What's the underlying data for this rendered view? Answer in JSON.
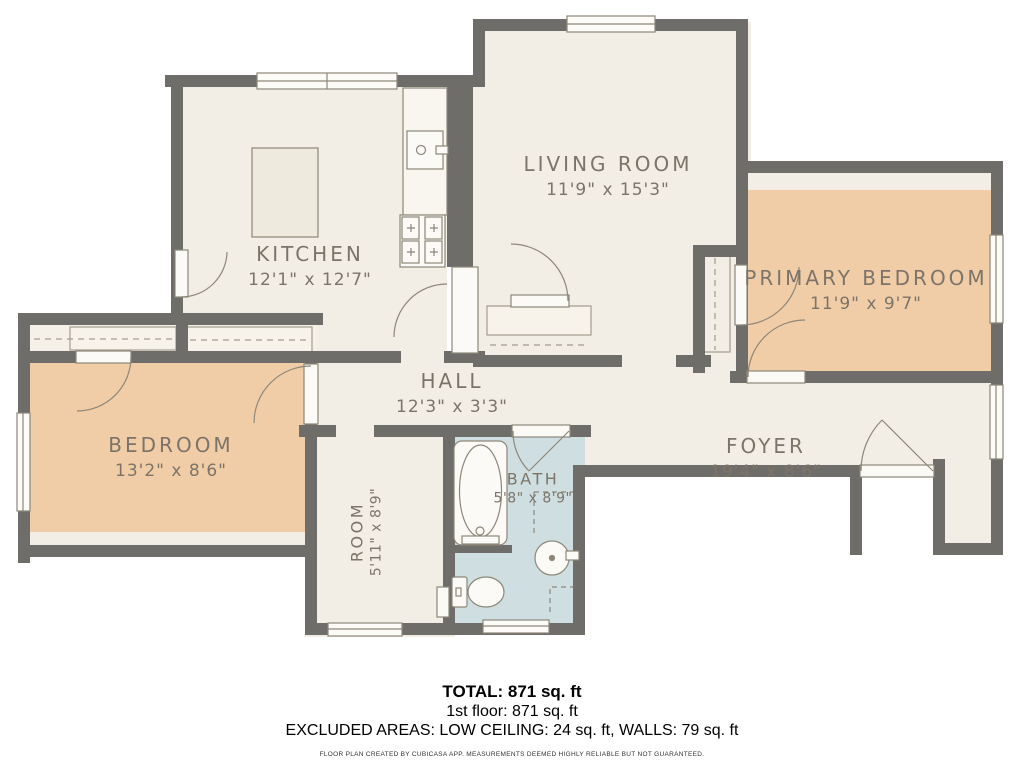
{
  "colors": {
    "wall": "#6f6d69",
    "floor_cream": "#f2eee5",
    "closet_cream": "#f5f1e9",
    "bedroom_peach": "#f1cda7",
    "bath_blue": "#cfdfe1",
    "fixture_line": "#8d8779",
    "label_text": "#7c7468",
    "window_fill": "#fcfbf8"
  },
  "rooms": [
    {
      "name": "KITCHEN",
      "dims": "12'1\" x 12'7\""
    },
    {
      "name": "LIVING ROOM",
      "dims": "11'9\" x 15'3\""
    },
    {
      "name": "PRIMARY BEDROOM",
      "dims": "11'9\" x 9'7\""
    },
    {
      "name": "BEDROOM",
      "dims": "13'2\" x 8'6\""
    },
    {
      "name": "HALL",
      "dims": "12'3\" x 3'3\""
    },
    {
      "name": "FOYER",
      "dims": "19'4\" x 8'6\""
    },
    {
      "name": "BATH",
      "dims": "5'8\" x 8'9\""
    },
    {
      "name": "ROOM",
      "dims": "5'11\" x 8'9\""
    }
  ],
  "summary": {
    "total": "TOTAL: 871 sq. ft",
    "floor": "1st floor: 871 sq. ft",
    "excluded": "EXCLUDED AREAS: LOW CEILING: 24 sq. ft, WALLS: 79 sq. ft",
    "disclaimer": "FLOOR PLAN CREATED BY CUBICASA APP. MEASUREMENTS DEEMED HIGHLY RELIABLE BUT NOT GUARANTEED."
  }
}
